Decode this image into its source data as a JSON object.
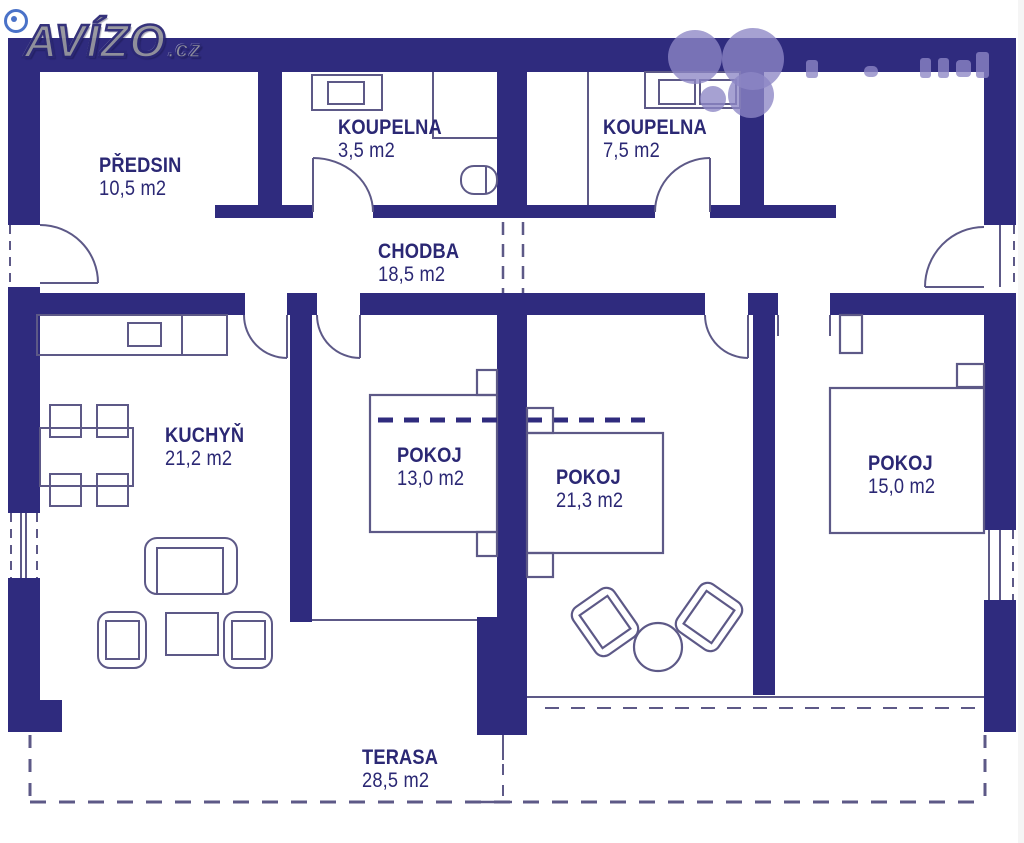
{
  "branding": {
    "logo": "AVÍZO",
    "logo_tld": ".cz"
  },
  "rooms": {
    "predsin": {
      "name": "PŘEDSIN",
      "area": "10,5 m2"
    },
    "koupelna_small": {
      "name": "KOUPELNA",
      "area": "3,5 m2"
    },
    "koupelna_large": {
      "name": "KOUPELNA",
      "area": "7,5 m2"
    },
    "chodba": {
      "name": "CHODBA",
      "area": "18,5 m2"
    },
    "kuchyn": {
      "name": "KUCHYŇ",
      "area": "21,2 m2"
    },
    "pokoj_13": {
      "name": "POKOJ",
      "area": "13,0 m2"
    },
    "pokoj_21": {
      "name": "POKOJ",
      "area": "21,3 m2"
    },
    "pokoj_15": {
      "name": "POKOJ",
      "area": "15,0 m2"
    },
    "terasa": {
      "name": "TERASA",
      "area": "28,5 m2"
    }
  },
  "colors": {
    "wall": "#2f2b7e",
    "furniture_line": "#5d5987",
    "label_text": "#2b2874",
    "watermark": "#8d87c5",
    "logo_fill": "#95959d"
  }
}
